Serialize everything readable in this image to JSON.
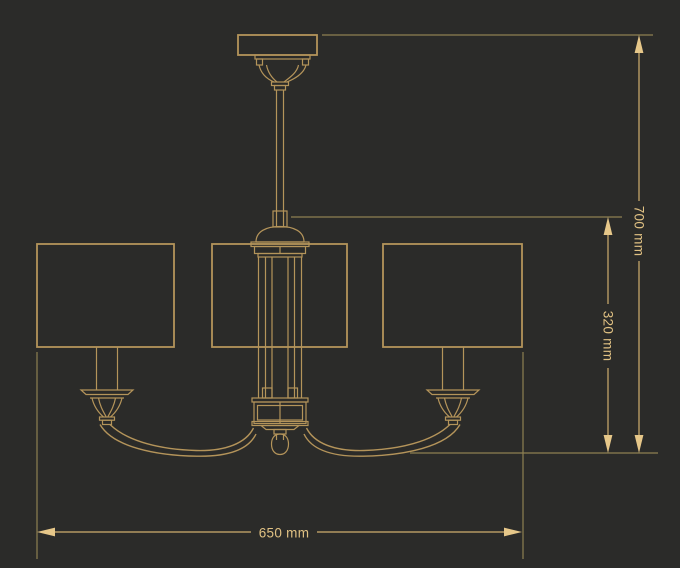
{
  "canvas": {
    "background": "#2b2b29"
  },
  "drawing": {
    "line_color": "#b4945a"
  },
  "dimensions": {
    "line_color": "#cfae6e",
    "extension_line_color": "#8e8052",
    "arrow_color": "#e6c789",
    "text_color": "#e0c183",
    "width": {
      "label": "650 mm"
    },
    "overall_height": {
      "label": "700 mm"
    },
    "body_height": {
      "label": "320 mm"
    }
  }
}
